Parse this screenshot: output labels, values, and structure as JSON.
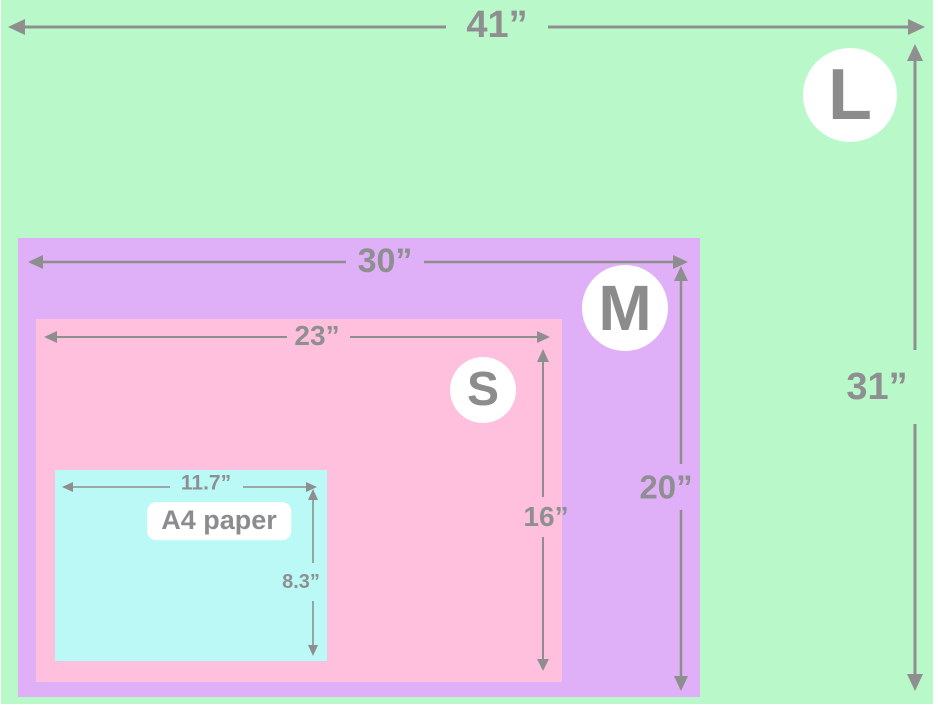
{
  "diagram": {
    "type": "size-comparison",
    "unit": "inches",
    "colors": {
      "size_l_green": "#b9f8c9",
      "size_m_purple": "#dfb0f7",
      "size_s_pink": "#fec0dd",
      "a4_cyan": "#bbf9f7",
      "dimension_gray": "#8f8f92",
      "badge_white": "#ffffff"
    },
    "sizes": {
      "l": {
        "badge": "L",
        "width_label": "41”",
        "height_label": "31”"
      },
      "m": {
        "badge": "M",
        "width_label": "30”",
        "height_label": "20”"
      },
      "s": {
        "badge": "S",
        "width_label": "23”",
        "height_label": "16”"
      },
      "a4": {
        "name": "A4 paper",
        "width_label": "11.7”",
        "height_label": "8.3”"
      }
    }
  }
}
